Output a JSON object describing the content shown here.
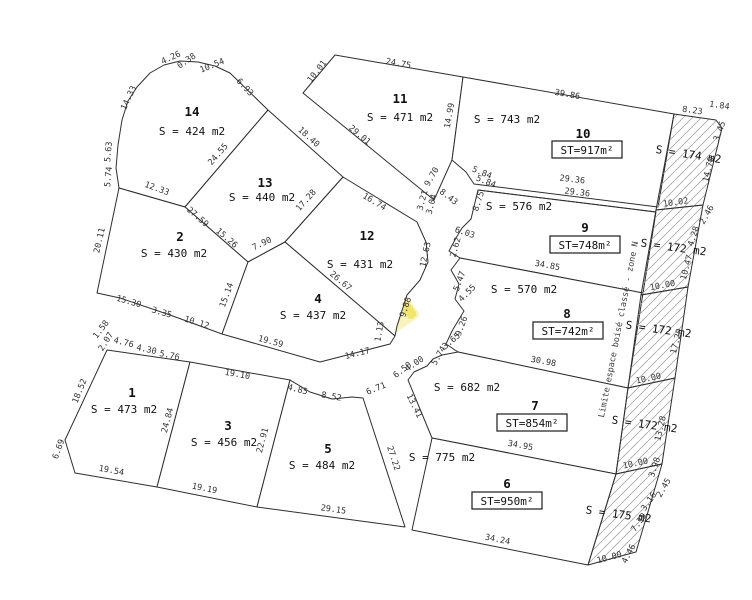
{
  "drawing": {
    "width": 752,
    "height": 600,
    "stroke_color": "#2e2e2e",
    "hatch_color": "#a6a6a6",
    "watermark_yellow": "#f0e154",
    "watermark_card": "#f9f3b4"
  },
  "note": {
    "text": "Limite espace boisé classé - zone N",
    "x": 621,
    "y": 330,
    "rot": -79
  },
  "watermark": {
    "cx": 378,
    "cy": 305,
    "rot": -35,
    "texts": [
      {
        "t": "SAS DC",
        "x": 412,
        "y": 276,
        "r": -50
      },
      {
        "t": "IMMOBILIERE",
        "x": 354,
        "y": 334,
        "r": -50
      }
    ]
  },
  "parcels": [
    {
      "number": "14",
      "area": "S = 424 m2",
      "st": null,
      "polygon": [
        [
          119,
          188
        ],
        [
          116,
          168
        ],
        [
          118,
          145
        ],
        [
          122,
          120
        ],
        [
          128,
          101
        ],
        [
          137,
          87
        ],
        [
          150,
          73
        ],
        [
          164,
          65
        ],
        [
          180,
          61
        ],
        [
          198,
          62
        ],
        [
          215,
          66
        ],
        [
          230,
          73
        ],
        [
          268,
          110
        ],
        [
          185,
          207
        ]
      ],
      "number_pos": [
        192,
        116
      ],
      "area_pos": [
        192,
        135
      ],
      "st_pos": null
    },
    {
      "number": "13",
      "area": "S = 440 m2",
      "st": null,
      "polygon": [
        [
          268,
          110
        ],
        [
          343,
          177
        ],
        [
          285,
          242
        ],
        [
          248,
          262
        ],
        [
          185,
          207
        ]
      ],
      "number_pos": [
        265,
        187
      ],
      "area_pos": [
        262,
        201
      ],
      "st_pos": null
    },
    {
      "number": "2",
      "area": "S = 430 m2",
      "st": null,
      "polygon": [
        [
          119,
          188
        ],
        [
          185,
          207
        ],
        [
          248,
          262
        ],
        [
          222,
          334
        ],
        [
          170,
          315
        ],
        [
          120,
          298
        ],
        [
          97,
          293
        ]
      ],
      "number_pos": [
        180,
        241
      ],
      "area_pos": [
        174,
        257
      ],
      "st_pos": null
    },
    {
      "number": "12",
      "area": "S = 431 m2",
      "st": null,
      "polygon": [
        [
          343,
          177
        ],
        [
          417,
          222
        ],
        [
          426,
          242
        ],
        [
          428,
          262
        ],
        [
          420,
          280
        ],
        [
          407,
          295
        ],
        [
          397,
          326
        ],
        [
          395,
          336
        ],
        [
          285,
          242
        ]
      ],
      "number_pos": [
        367,
        240
      ],
      "area_pos": [
        360,
        268
      ],
      "st_pos": null
    },
    {
      "number": "4",
      "area": "S = 437 m2",
      "st": null,
      "polygon": [
        [
          248,
          262
        ],
        [
          285,
          242
        ],
        [
          395,
          336
        ],
        [
          390,
          344
        ],
        [
          320,
          362
        ],
        [
          222,
          334
        ]
      ],
      "number_pos": [
        318,
        303
      ],
      "area_pos": [
        313,
        319
      ],
      "st_pos": null
    },
    {
      "number": "11",
      "area": "S = 471 m2",
      "st": null,
      "polygon": [
        [
          335,
          55
        ],
        [
          463,
          77
        ],
        [
          452,
          160
        ],
        [
          434,
          200
        ],
        [
          303,
          93
        ]
      ],
      "number_pos": [
        400,
        103
      ],
      "area_pos": [
        400,
        121
      ],
      "st_pos": null
    },
    {
      "number": "10",
      "area": "S = 743 m2",
      "st": "ST=917m²",
      "polygon": [
        [
          463,
          77
        ],
        [
          674,
          114
        ],
        [
          658,
          207
        ],
        [
          474,
          184
        ],
        [
          466,
          172
        ],
        [
          452,
          160
        ]
      ],
      "number_pos": [
        583,
        138
      ],
      "area_pos": [
        507,
        123
      ],
      "st_pos": [
        587,
        153
      ]
    },
    {
      "number": "9",
      "area": "S = 576 m2",
      "st": "ST=748m²",
      "polygon": [
        [
          478,
          190
        ],
        [
          656,
          212
        ],
        [
          643,
          293
        ],
        [
          460,
          258
        ],
        [
          449,
          251
        ],
        [
          456,
          238
        ],
        [
          462,
          228
        ],
        [
          471,
          219
        ]
      ],
      "number_pos": [
        585,
        232
      ],
      "area_pos": [
        519,
        210
      ],
      "st_pos": [
        585,
        248
      ]
    },
    {
      "number": "8",
      "area": "S = 570 m2",
      "st": "ST=742m²",
      "polygon": [
        [
          460,
          258
        ],
        [
          643,
          293
        ],
        [
          628,
          388
        ],
        [
          458,
          352
        ],
        [
          446,
          344
        ],
        [
          452,
          331
        ],
        [
          464,
          311
        ],
        [
          455,
          299
        ],
        [
          459,
          284
        ],
        [
          451,
          270
        ]
      ],
      "number_pos": [
        567,
        318
      ],
      "area_pos": [
        524,
        293
      ],
      "st_pos": [
        568,
        334
      ]
    },
    {
      "number": "7",
      "area": "S = 682 m2",
      "st": "ST=854m²",
      "polygon": [
        [
          458,
          352
        ],
        [
          628,
          388
        ],
        [
          616,
          474
        ],
        [
          432,
          438
        ],
        [
          408,
          380
        ],
        [
          414,
          372
        ],
        [
          427,
          366
        ],
        [
          433,
          359
        ],
        [
          442,
          355
        ]
      ],
      "number_pos": [
        535,
        410
      ],
      "area_pos": [
        467,
        391
      ],
      "st_pos": [
        532,
        426
      ]
    },
    {
      "number": "6",
      "area": "S = 775 m2",
      "st": "ST=950m²",
      "polygon": [
        [
          432,
          438
        ],
        [
          616,
          474
        ],
        [
          588,
          565
        ],
        [
          412,
          530
        ]
      ],
      "number_pos": [
        507,
        488
      ],
      "area_pos": [
        442,
        461
      ],
      "st_pos": [
        507,
        504
      ]
    },
    {
      "number": "1",
      "area": "S = 473 m2",
      "st": null,
      "polygon": [
        [
          107,
          350
        ],
        [
          190,
          362
        ],
        [
          157,
          487
        ],
        [
          75,
          473
        ],
        [
          65,
          440
        ]
      ],
      "number_pos": [
        132,
        397
      ],
      "area_pos": [
        124,
        413
      ],
      "st_pos": null
    },
    {
      "number": "3",
      "area": "S = 456 m2",
      "st": null,
      "polygon": [
        [
          190,
          362
        ],
        [
          290,
          380
        ],
        [
          257,
          507
        ],
        [
          157,
          487
        ]
      ],
      "number_pos": [
        228,
        430
      ],
      "area_pos": [
        224,
        446
      ],
      "st_pos": null
    },
    {
      "number": "5",
      "area": "S = 484 m2",
      "st": null,
      "polygon": [
        [
          290,
          380
        ],
        [
          310,
          392
        ],
        [
          332,
          399
        ],
        [
          352,
          397
        ],
        [
          363,
          398
        ],
        [
          405,
          527
        ],
        [
          257,
          507
        ]
      ],
      "number_pos": [
        328,
        453
      ],
      "area_pos": [
        322,
        469
      ],
      "st_pos": null
    }
  ],
  "hatch_parcels": [
    {
      "area": "S = 174 m2",
      "polygon": [
        [
          674,
          114
        ],
        [
          716,
          120
        ],
        [
          722,
          128
        ],
        [
          703,
          205
        ],
        [
          656,
          210
        ]
      ],
      "area_pos": [
        688,
        158
      ],
      "rot": 9
    },
    {
      "area": "S = 172 m2",
      "polygon": [
        [
          656,
          210
        ],
        [
          703,
          205
        ],
        [
          688,
          287
        ],
        [
          641,
          295
        ]
      ],
      "area_pos": [
        673,
        251
      ],
      "rot": 8
    },
    {
      "area": "S = 172 m2",
      "polygon": [
        [
          641,
          295
        ],
        [
          688,
          287
        ],
        [
          675,
          378
        ],
        [
          628,
          388
        ]
      ],
      "area_pos": [
        658,
        333
      ],
      "rot": 8
    },
    {
      "area": "S = 172 m2",
      "polygon": [
        [
          628,
          388
        ],
        [
          675,
          378
        ],
        [
          662,
          464
        ],
        [
          616,
          474
        ]
      ],
      "area_pos": [
        644,
        428
      ],
      "rot": 8
    },
    {
      "area": "S = 175 m2",
      "polygon": [
        [
          616,
          474
        ],
        [
          662,
          464
        ],
        [
          650,
          505
        ],
        [
          636,
          552
        ],
        [
          588,
          565
        ]
      ],
      "area_pos": [
        618,
        518
      ],
      "rot": 8
    }
  ],
  "extra_lines": [
    [
      [
        478,
        190
      ],
      [
        656,
        212
      ]
    ]
  ],
  "dimensions": [
    {
      "t": "4.26",
      "x": 172,
      "y": 60,
      "r": -25
    },
    {
      "t": "0.38",
      "x": 188,
      "y": 63,
      "r": -35
    },
    {
      "t": "10.54",
      "x": 213,
      "y": 68,
      "r": -22
    },
    {
      "t": "6.93",
      "x": 243,
      "y": 89,
      "r": 47
    },
    {
      "t": "14.33",
      "x": 131,
      "y": 99,
      "r": -65
    },
    {
      "t": "5.63",
      "x": 111,
      "y": 152,
      "r": -85
    },
    {
      "t": "5.74",
      "x": 111,
      "y": 177,
      "r": -85
    },
    {
      "t": "12.33",
      "x": 156,
      "y": 191,
      "r": 20
    },
    {
      "t": "24.55",
      "x": 220,
      "y": 156,
      "r": -49
    },
    {
      "t": "18.40",
      "x": 307,
      "y": 139,
      "r": 42
    },
    {
      "t": "27.59",
      "x": 196,
      "y": 219,
      "r": 41
    },
    {
      "t": "15.26",
      "x": 225,
      "y": 240,
      "r": 41
    },
    {
      "t": "17.28",
      "x": 308,
      "y": 202,
      "r": -48
    },
    {
      "t": "7.90",
      "x": 263,
      "y": 246,
      "r": -25
    },
    {
      "t": "20.11",
      "x": 102,
      "y": 241,
      "r": -77
    },
    {
      "t": "15.30",
      "x": 128,
      "y": 304,
      "r": 16
    },
    {
      "t": "3.35",
      "x": 161,
      "y": 315,
      "r": 16
    },
    {
      "t": "10.12",
      "x": 196,
      "y": 325,
      "r": 17
    },
    {
      "t": "15.14",
      "x": 229,
      "y": 296,
      "r": -70
    },
    {
      "t": "10.01",
      "x": 319,
      "y": 73,
      "r": -52
    },
    {
      "t": "24.75",
      "x": 398,
      "y": 66,
      "r": 10
    },
    {
      "t": "29.01",
      "x": 358,
      "y": 137,
      "r": 40
    },
    {
      "t": "14.99",
      "x": 452,
      "y": 116,
      "r": -80
    },
    {
      "t": "9.70",
      "x": 434,
      "y": 178,
      "r": -60
    },
    {
      "t": "3.21",
      "x": 425,
      "y": 201,
      "r": -75
    },
    {
      "t": "3.04",
      "x": 434,
      "y": 205,
      "r": -75
    },
    {
      "t": "8.43",
      "x": 447,
      "y": 199,
      "r": 38
    },
    {
      "t": "5.84",
      "x": 481,
      "y": 175,
      "r": 22
    },
    {
      "t": "5.84",
      "x": 485,
      "y": 184,
      "r": 22
    },
    {
      "t": "8.75",
      "x": 481,
      "y": 202,
      "r": -72
    },
    {
      "t": "6.03",
      "x": 464,
      "y": 235,
      "r": 18
    },
    {
      "t": "2.62",
      "x": 458,
      "y": 248,
      "r": -75
    },
    {
      "t": "39.86",
      "x": 567,
      "y": 97,
      "r": 10
    },
    {
      "t": "8.23",
      "x": 692,
      "y": 113,
      "r": 8
    },
    {
      "t": "1.84",
      "x": 719,
      "y": 108,
      "r": 8
    },
    {
      "t": "3.45",
      "x": 722,
      "y": 132,
      "r": -70
    },
    {
      "t": "14.70",
      "x": 711,
      "y": 170,
      "r": -77
    },
    {
      "t": "10.02",
      "x": 676,
      "y": 205,
      "r": -8
    },
    {
      "t": "29.36",
      "x": 572,
      "y": 182,
      "r": 7
    },
    {
      "t": "29.36",
      "x": 577,
      "y": 195,
      "r": 7
    },
    {
      "t": "2.46",
      "x": 709,
      "y": 216,
      "r": -60
    },
    {
      "t": "4.28",
      "x": 696,
      "y": 237,
      "r": -72
    },
    {
      "t": "10.47",
      "x": 689,
      "y": 268,
      "r": -75
    },
    {
      "t": "34.85",
      "x": 547,
      "y": 268,
      "r": 10
    },
    {
      "t": "5.47",
      "x": 462,
      "y": 282,
      "r": -70
    },
    {
      "t": "4.55",
      "x": 469,
      "y": 295,
      "r": -45
    },
    {
      "t": "10.00",
      "x": 663,
      "y": 288,
      "r": -10
    },
    {
      "t": "17.20",
      "x": 679,
      "y": 342,
      "r": -75
    },
    {
      "t": "9.26",
      "x": 464,
      "y": 327,
      "r": -70
    },
    {
      "t": "3.65",
      "x": 453,
      "y": 343,
      "r": -40
    },
    {
      "t": "5.74",
      "x": 441,
      "y": 357,
      "r": -60
    },
    {
      "t": "30.98",
      "x": 543,
      "y": 364,
      "r": 10
    },
    {
      "t": "10.00",
      "x": 649,
      "y": 381,
      "r": -12
    },
    {
      "t": "13.28",
      "x": 663,
      "y": 429,
      "r": -77
    },
    {
      "t": "6.50",
      "x": 404,
      "y": 372,
      "r": -38
    },
    {
      "t": "4.00",
      "x": 416,
      "y": 366,
      "r": -35
    },
    {
      "t": "6.71",
      "x": 377,
      "y": 391,
      "r": -22
    },
    {
      "t": "13.41",
      "x": 412,
      "y": 407,
      "r": 64
    },
    {
      "t": "34.95",
      "x": 520,
      "y": 448,
      "r": 10
    },
    {
      "t": "10.00",
      "x": 636,
      "y": 466,
      "r": -12
    },
    {
      "t": "3.98",
      "x": 657,
      "y": 468,
      "r": -72
    },
    {
      "t": "2.45",
      "x": 666,
      "y": 489,
      "r": -60
    },
    {
      "t": "3.16",
      "x": 651,
      "y": 503,
      "r": -55
    },
    {
      "t": "7.39",
      "x": 641,
      "y": 524,
      "r": -55
    },
    {
      "t": "4.46",
      "x": 631,
      "y": 555,
      "r": -62
    },
    {
      "t": "10.00",
      "x": 610,
      "y": 560,
      "r": -15
    },
    {
      "t": "34.24",
      "x": 497,
      "y": 542,
      "r": 11
    },
    {
      "t": "29.15",
      "x": 333,
      "y": 512,
      "r": 8
    },
    {
      "t": "19.19",
      "x": 204,
      "y": 491,
      "r": 11
    },
    {
      "t": "19.54",
      "x": 111,
      "y": 473,
      "r": 10
    },
    {
      "t": "6.69",
      "x": 61,
      "y": 450,
      "r": -70
    },
    {
      "t": "18.52",
      "x": 82,
      "y": 392,
      "r": -68
    },
    {
      "t": "24.84",
      "x": 170,
      "y": 421,
      "r": -75
    },
    {
      "t": "22.91",
      "x": 265,
      "y": 441,
      "r": -75
    },
    {
      "t": "27.22",
      "x": 391,
      "y": 459,
      "r": 72
    },
    {
      "t": "19.10",
      "x": 237,
      "y": 377,
      "r": 10
    },
    {
      "t": "1.58",
      "x": 103,
      "y": 331,
      "r": -52
    },
    {
      "t": "2.07",
      "x": 108,
      "y": 343,
      "r": -58
    },
    {
      "t": "4.76",
      "x": 123,
      "y": 345,
      "r": 14
    },
    {
      "t": "4.30",
      "x": 146,
      "y": 352,
      "r": 12
    },
    {
      "t": "5.76",
      "x": 169,
      "y": 358,
      "r": 12
    },
    {
      "t": "4.85",
      "x": 297,
      "y": 392,
      "r": 14
    },
    {
      "t": "8.52",
      "x": 331,
      "y": 399,
      "r": 10
    },
    {
      "t": "19.59",
      "x": 270,
      "y": 344,
      "r": 15
    },
    {
      "t": "14.17",
      "x": 358,
      "y": 356,
      "r": -14
    },
    {
      "t": "9.88",
      "x": 408,
      "y": 308,
      "r": -72
    },
    {
      "t": "1.13",
      "x": 382,
      "y": 332,
      "r": -80
    },
    {
      "t": "12.63",
      "x": 428,
      "y": 255,
      "r": -78
    },
    {
      "t": "16.74",
      "x": 373,
      "y": 204,
      "r": 31
    },
    {
      "t": "26.67",
      "x": 339,
      "y": 283,
      "r": 40
    }
  ]
}
